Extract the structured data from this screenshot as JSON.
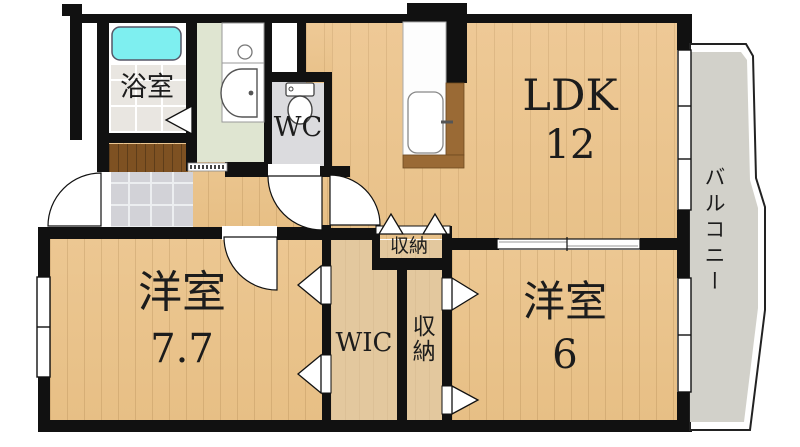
{
  "floorplan": {
    "title": "apartment floor plan",
    "rooms": {
      "ldk": {
        "label": "LDK",
        "size": "12"
      },
      "bedroom1": {
        "label": "洋室",
        "size": "7.7"
      },
      "bedroom2": {
        "label": "洋室",
        "size": "6"
      },
      "wic": {
        "label": "WIC"
      },
      "storage_top": {
        "label": "収納"
      },
      "storage_side": {
        "label": "収納"
      },
      "wc": {
        "label": "WC"
      },
      "bathroom": {
        "label": "浴室"
      },
      "balcony": {
        "label": "バルコニー"
      }
    },
    "fixtures": [
      "bathtub",
      "washbasin",
      "toilet",
      "kitchen-sink"
    ],
    "colors": {
      "wall": "#111111",
      "wood_floor": "#ecc792",
      "closet_floor": "#e3c89e",
      "bathtub": "#7eeff0",
      "balcony_floor": "#d2d1ca",
      "entrance_tile": "#d2d2d7",
      "washroom_floor": "#dfe5d1",
      "wc_floor": "#dbdbde",
      "step_wood": "#7e5122",
      "counter_wood": "#9a6a35"
    }
  }
}
